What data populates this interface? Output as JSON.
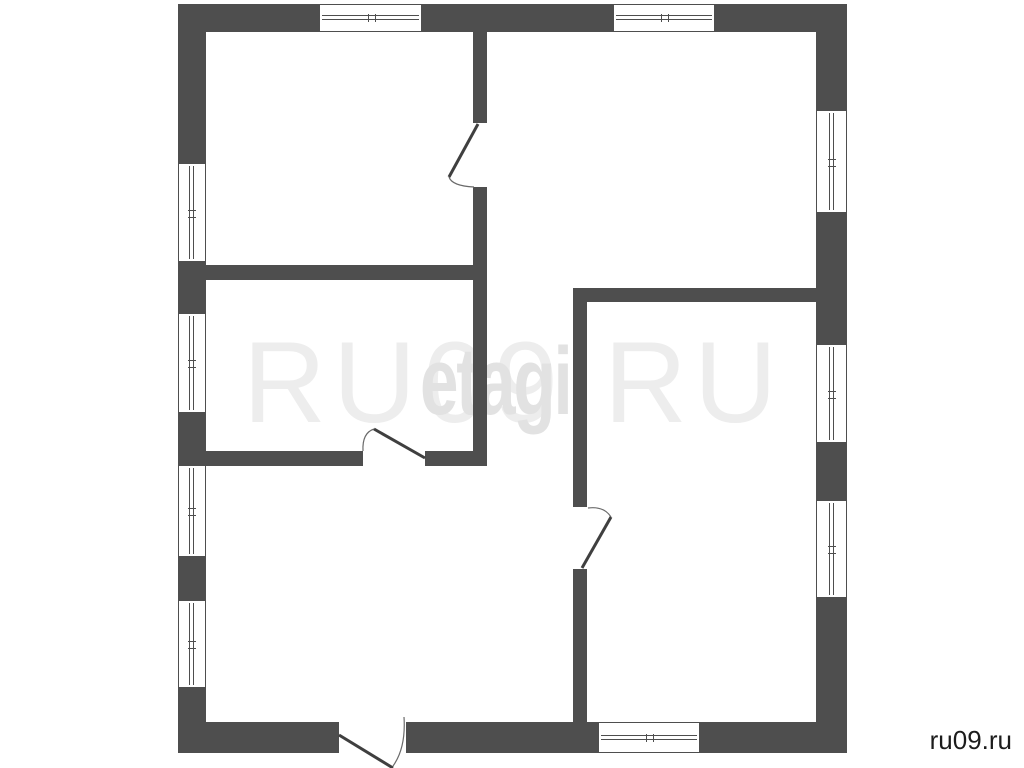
{
  "watermark": {
    "main": "RU09.RU",
    "agency": "etagi"
  },
  "footer": {
    "site": "ru09.ru"
  },
  "colors": {
    "wall": "#4e4e4e",
    "door_leaf": "#3f3f3f",
    "door_arc": "#6a6a6a",
    "background": "#ffffff",
    "watermark_main": "#ededed",
    "watermark_agency": "#e2e2e2",
    "footer_text": "#1c1c1c"
  }
}
